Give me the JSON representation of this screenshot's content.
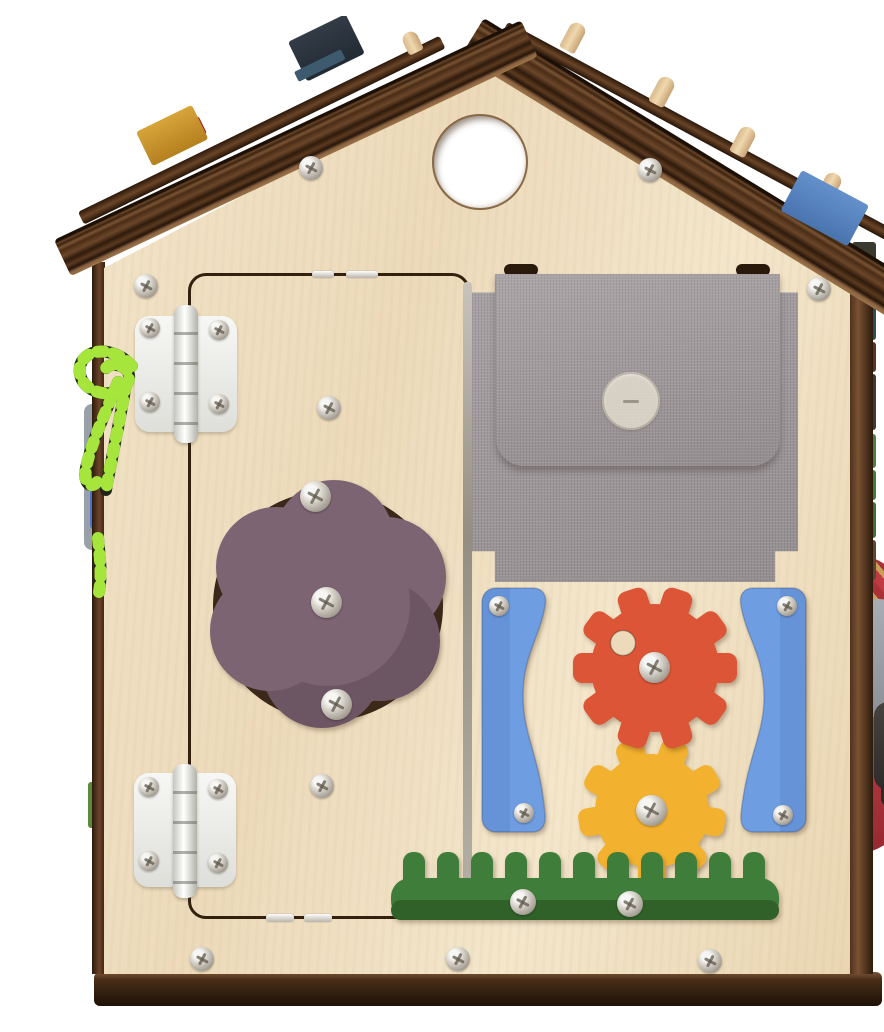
{
  "scene": {
    "title": "Wooden busy board house — back side",
    "description": "Plywood toy busy-board house: dark plank roof with colored blocks and wooden pegs, round gable window hole, hinged door with plum flower turn-knob on a circular track, gray linen button pocket, red and yellow wooden gears between blue wavy rails above a green grass rack, two white hinges, striped lacing cord and fabric elements on the sides, dark wooden base"
  },
  "palette": {
    "bg": "#ffffff",
    "wall-a": "#f3e6cb",
    "wall-b": "#ecdaba",
    "wall-c": "#e7d2ac",
    "base-a": "#33200f",
    "door-line": "#33200f",
    "roof-dark": "#2c1a0c",
    "roof-mid": "#6b4629",
    "fabric-a": "#a7a1a3",
    "fabric-b": "#948e90",
    "button": "#e4ded0",
    "blue-panel": "#6f9de2",
    "blue-panel-deep": "#5b87c8",
    "gear-red": "#dc5536",
    "gear-yellow": "#f2b12e",
    "grass": "#3f7d3a",
    "grass-deep": "#2f6129",
    "flower": "#7c6473",
    "flower-deep": "#6d5664",
    "track-ring": "#3b281a",
    "screw-light": "#f6f6f4",
    "screw-mid": "#b4afa5",
    "screw-dark": "#7d7265",
    "peg": "#e6c89e",
    "block-yellow": "#c6922e",
    "block-red": "#9c2e22",
    "block-navy": "#2a3440",
    "block-blue": "#5580bf",
    "lace-dark": "#20241a",
    "lace-green": "#a6e53c",
    "felt-gray": "#99a0a8",
    "felt-blue": "#4a6fd0",
    "side-green": "#5c8a3c",
    "fabric-red": "#bf3b43",
    "weave-tan": "#c8a058",
    "zipper": "#3a3836"
  },
  "parts": [
    {
      "id": "roof",
      "label": "Plank roof with play blocks and pegs"
    },
    {
      "id": "gable-hole",
      "label": "Round window cutout"
    },
    {
      "id": "door",
      "label": "Hinged plywood door"
    },
    {
      "id": "flower-knob",
      "label": "Plum flower rotating knob"
    },
    {
      "id": "hinges",
      "label": "Two white door hinges"
    },
    {
      "id": "pocket",
      "label": "Gray linen pocket with button flap"
    },
    {
      "id": "gears",
      "label": "Red and yellow wooden gears"
    },
    {
      "id": "blue-panels",
      "label": "Blue wavy side rails"
    },
    {
      "id": "grass",
      "label": "Green grass rack"
    },
    {
      "id": "lace",
      "label": "Green striped lacing cord"
    },
    {
      "id": "base",
      "label": "Dark wooden base board"
    }
  ]
}
